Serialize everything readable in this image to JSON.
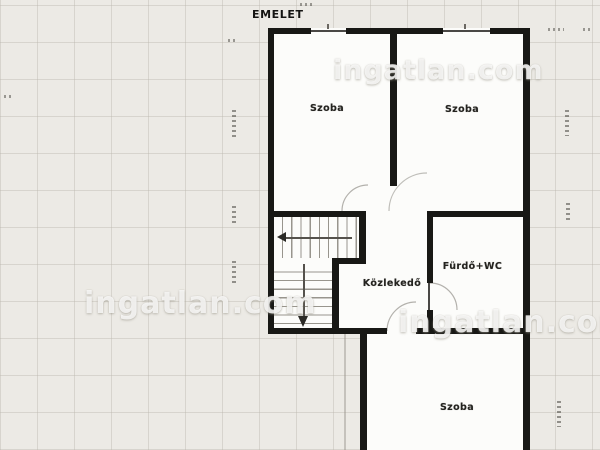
{
  "title": "EMELET",
  "rooms": {
    "szoba_left": {
      "label": "Szoba"
    },
    "szoba_right": {
      "label": "Szoba"
    },
    "furdo_wc": {
      "label": "Fürdő+WC"
    },
    "kozlekedo": {
      "label": "Közlekedő"
    },
    "szoba_bottom": {
      "label": "Szoba"
    }
  },
  "watermark": {
    "text": "ingatlan.com"
  },
  "colors": {
    "wall": "#181815",
    "background": "#eceae5",
    "interior": "#fcfcfa",
    "stair_line": "#98958d",
    "label_text": "#24231f",
    "watermark_text": "rgba(255,255,255,0.80)"
  }
}
